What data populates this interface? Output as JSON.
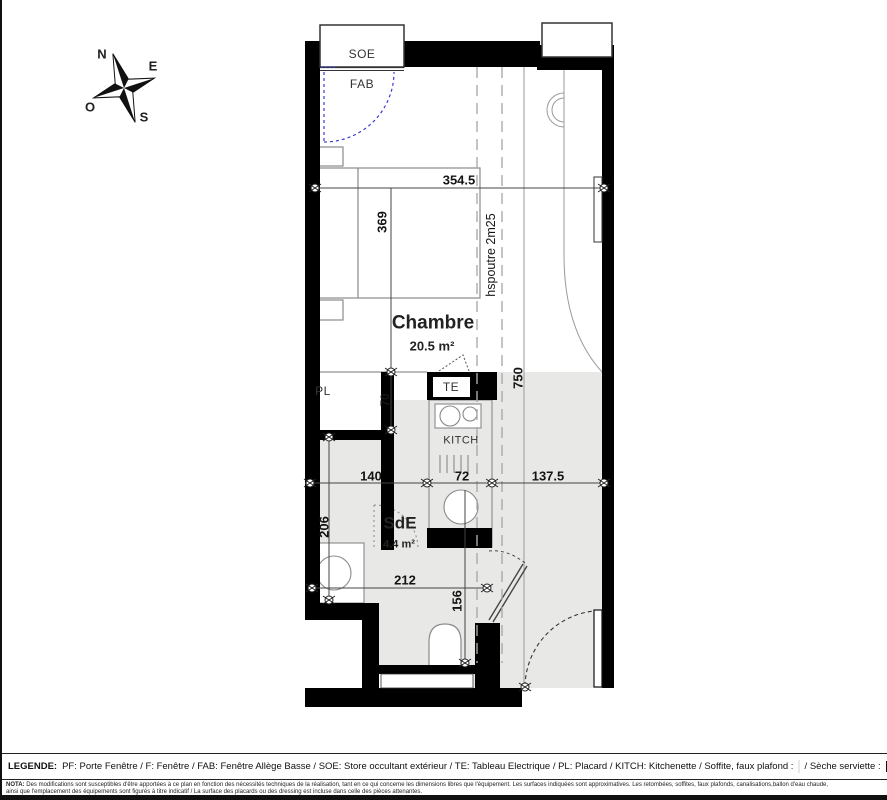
{
  "plan": {
    "compass": {
      "north": "N",
      "east": "E",
      "south": "S",
      "west": "O"
    },
    "window_labels": {
      "soe": "SOE",
      "fab": "FAB"
    },
    "room_labels": {
      "chambre": {
        "name": "Chambre",
        "area": "20.5 m²"
      },
      "sde": {
        "name": "SdE",
        "area": "4.4 m²"
      }
    },
    "feature_labels": {
      "pl": "PL",
      "te": "TE",
      "kitch": "KITCH"
    },
    "dimensions": {
      "top_width": "354.5",
      "bed_length": "369",
      "beam_height": "hspoutre 2m25",
      "total_length": "750",
      "pl_width": "140",
      "kitch_width": "72",
      "entry_width": "137.5",
      "pl_depth": "70",
      "sde_depth": "206",
      "sde_width": "212",
      "wc_depth": "156"
    },
    "colors": {
      "wall": "#000000",
      "soffite_fill": "#e8e8e6",
      "window_swing": "#3b3bd4"
    }
  },
  "legend": {
    "title": "LEGENDE:",
    "items": "PF: Porte Fenêtre / F: Fenêtre / FAB: Fenêtre Allège Basse / SOE: Store occultant extérieur / TE: Tableau Electrique / PL: Placard / KITCH: Kitchenette / Soffite, faux plafond :",
    "seche_label": "/ Sèche serviette :"
  },
  "nota": {
    "title": "NOTA:",
    "line1": "Des modifications sont susceptibles d'être apportées à ce plan en fonction des nécessités techniques de la réalisation, tant en ce qui concerne les dimensions libres que l'équipement. Les surfaces indiquées sont approximatives. Les retombées, soffites, faux plafonds, canalisations,ballon d'eau chaude,",
    "line2": "ainsi que l'emplacement des équipements sont figurés à titre indicatif / La surface des placards ou des dressing est incluse dans celle des pièces attenantes."
  }
}
